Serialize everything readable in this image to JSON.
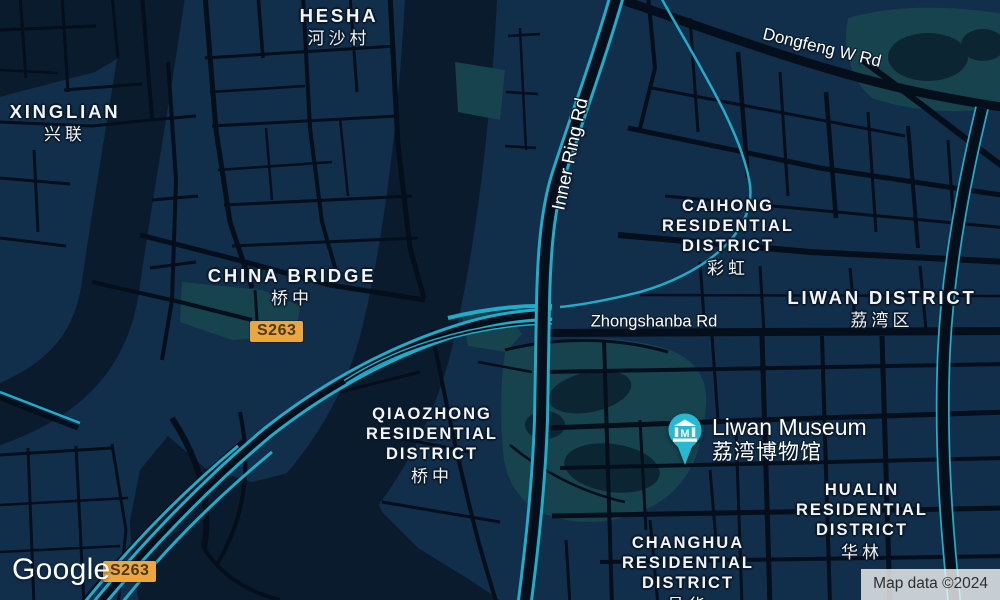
{
  "map_app": {
    "kind": "google-maps-dark-mode",
    "logo_text": "Google",
    "attribution_text": "Map data ©2024",
    "route_badges": [
      {
        "label": "S263"
      },
      {
        "label": "S263"
      }
    ],
    "road_labels": [
      {
        "id": "inner-ring-rd",
        "text": "Inner Ring Rd"
      },
      {
        "id": "dongfeng-w-rd",
        "text": "Dongfeng W Rd"
      },
      {
        "id": "zhongshanba-rd",
        "text": "Zhongshanba Rd"
      }
    ],
    "place_labels": [
      {
        "id": "hesha",
        "lines": [
          "HESHA",
          "河沙村"
        ]
      },
      {
        "id": "xinglian",
        "lines": [
          "XINGLIAN",
          "兴联"
        ]
      },
      {
        "id": "china-bridge",
        "lines": [
          "CHINA BRIDGE",
          "桥中"
        ]
      },
      {
        "id": "caihong",
        "lines": [
          "CAIHONG",
          "RESIDENTIAL",
          "DISTRICT",
          "彩虹"
        ]
      },
      {
        "id": "liwan-district",
        "lines": [
          "LIWAN DISTRICT",
          "荔湾区"
        ]
      },
      {
        "id": "qiaozhong",
        "lines": [
          "QIAOZHONG",
          "RESIDENTIAL",
          "DISTRICT",
          "桥中"
        ]
      },
      {
        "id": "hualin",
        "lines": [
          "HUALIN",
          "RESIDENTIAL",
          "DISTRICT",
          "华林"
        ]
      },
      {
        "id": "changhua",
        "lines": [
          "CHANGHUA",
          "RESIDENTIAL",
          "DISTRICT",
          "昌华"
        ]
      }
    ],
    "poi": {
      "name": "Liwan Museum",
      "name_zh": "荔湾博物馆",
      "marker_icon": "museum-pin-icon"
    },
    "colors": {
      "land": "#112e4b",
      "water": "#0a1b2e",
      "park": "#16434e",
      "pond": "#0b2533",
      "road": "#050e1b",
      "highway": "#1fadc9",
      "marker": "#28b9d2",
      "badge_bg": "#eda63e",
      "label_text": "#f2f4f7"
    }
  }
}
